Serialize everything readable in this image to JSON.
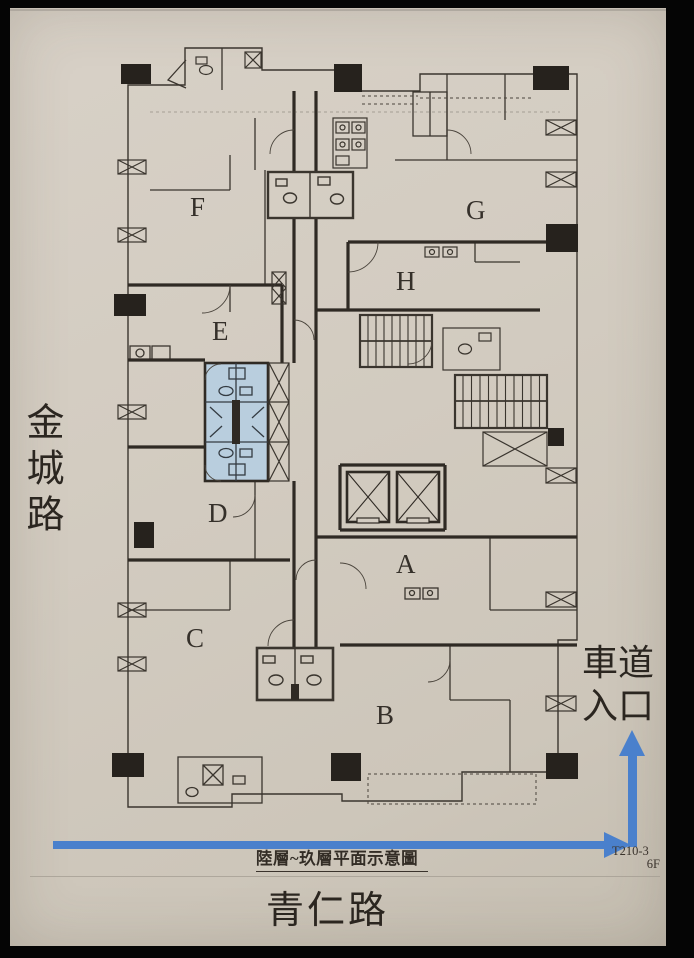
{
  "colors": {
    "paper": "#d3ccc1",
    "ink": "#3a352e",
    "arrow_blue": "#4a80cc",
    "highlight_blue": "#b9cede"
  },
  "roads": {
    "left_vertical": "金城路",
    "bottom": "青仁路"
  },
  "driveway": {
    "line1": "車道",
    "line2": "入口"
  },
  "titleblock": {
    "plan_title": "陸層~玖層平面示意圖",
    "drawing_no": "T210-3",
    "floor": "6F"
  },
  "plan": {
    "units": [
      {
        "label": "F"
      },
      {
        "label": "G"
      },
      {
        "label": "H"
      },
      {
        "label": "E"
      },
      {
        "label": "D"
      },
      {
        "label": "A"
      },
      {
        "label": "C"
      },
      {
        "label": "B"
      }
    ]
  }
}
